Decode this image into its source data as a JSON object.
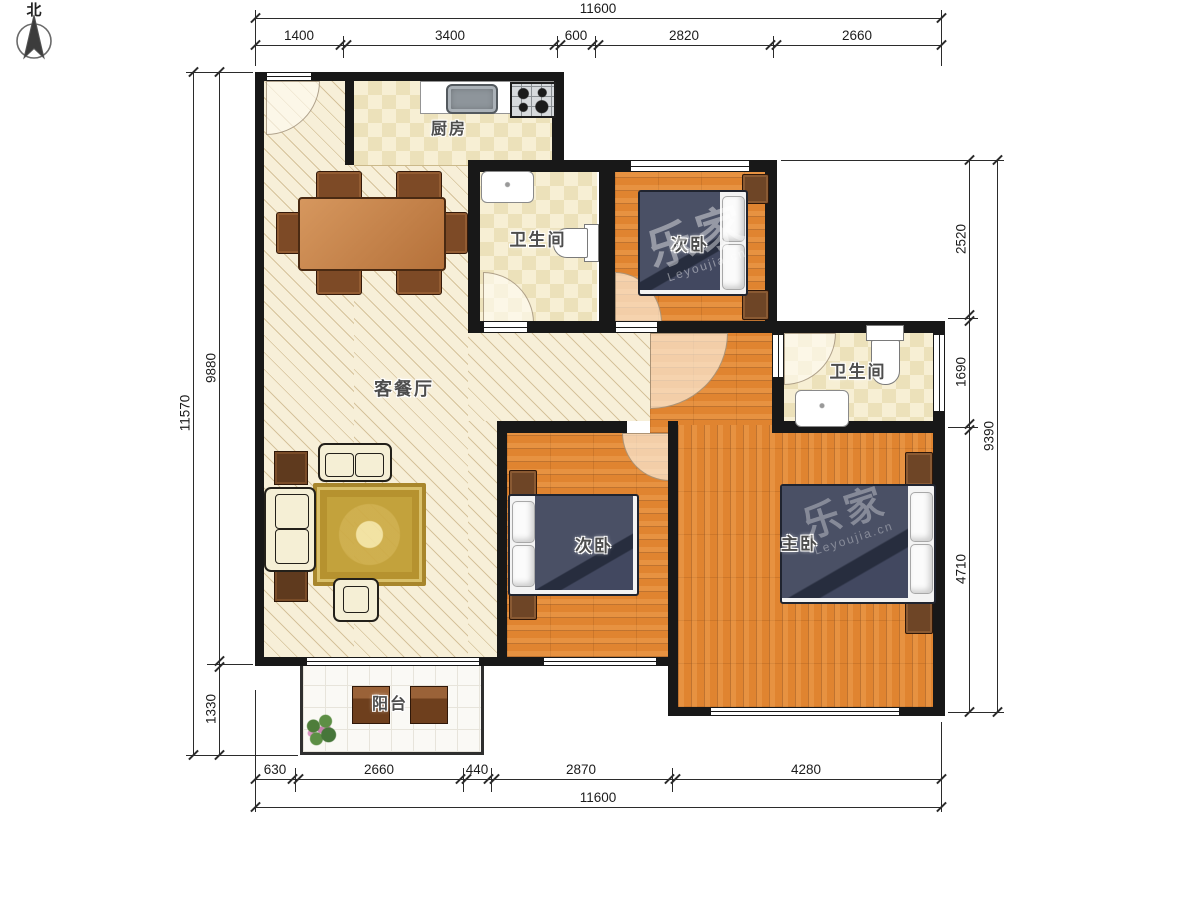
{
  "north": {
    "label": "北"
  },
  "rooms": {
    "kitchen": "厨房",
    "bath1": "卫生间",
    "bedroom1": "次卧",
    "bath2": "卫生间",
    "living": "客餐厅",
    "bedroom2": "次卧",
    "master": "主卧",
    "balcony": "阳台"
  },
  "watermark": {
    "cn": "乐家",
    "en": "Leyoujia.cn"
  },
  "dims": {
    "top": {
      "total": "11600",
      "segments": [
        "1400",
        "3400",
        "600",
        "2820",
        "2660"
      ]
    },
    "bottom": {
      "total": "11600",
      "segments": [
        "630",
        "2660",
        "440",
        "2870",
        "4280"
      ]
    },
    "left": {
      "total": "11570",
      "segments": [
        "9880",
        "1330"
      ]
    },
    "right": {
      "total": "9390",
      "segments": [
        "2520",
        "1690",
        "4710"
      ]
    }
  },
  "palette": {
    "wall": "#181818",
    "wood_floor": "#e08430",
    "tile_floor": "#ece1ba",
    "living_floor": "#f7efd8",
    "bed": "#3a4052",
    "furniture_brown": "#6e4526"
  }
}
